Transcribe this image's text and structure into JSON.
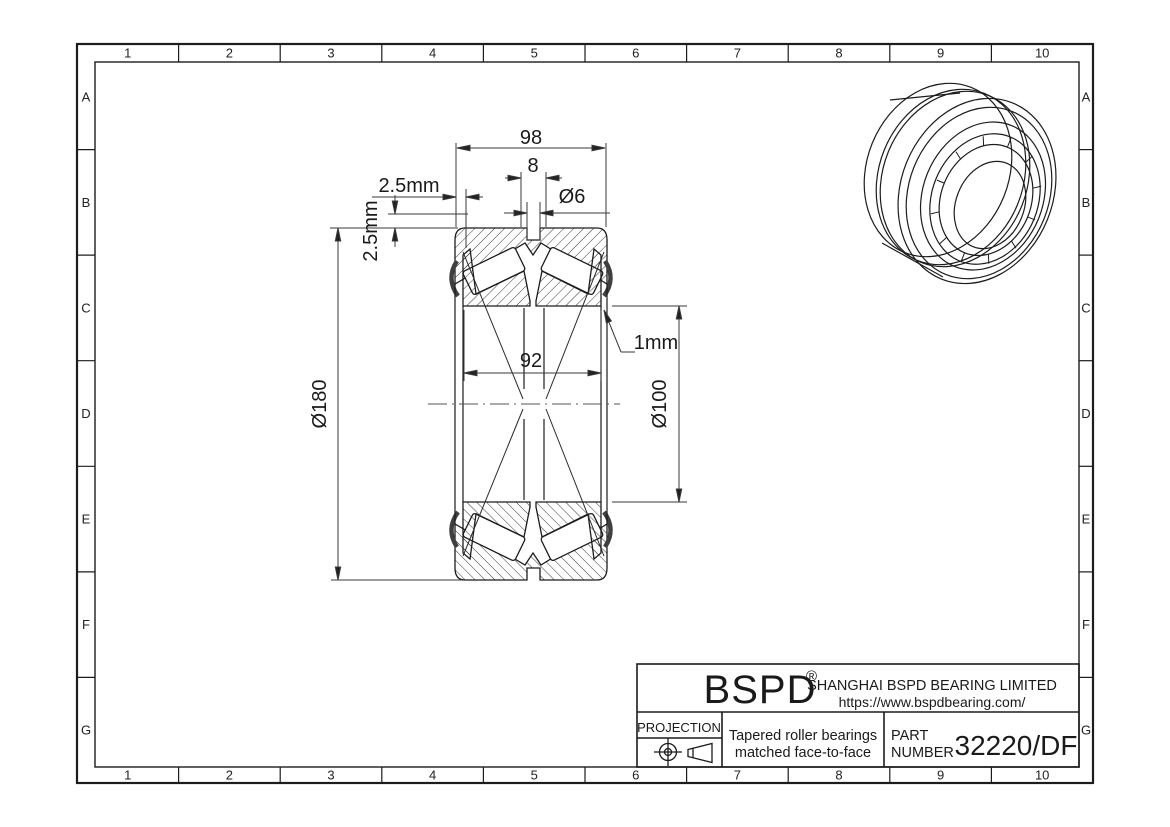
{
  "sheet": {
    "columns": [
      "1",
      "2",
      "3",
      "4",
      "5",
      "6",
      "7",
      "8",
      "9",
      "10"
    ],
    "rows": [
      "A",
      "B",
      "C",
      "D",
      "E",
      "F",
      "G"
    ]
  },
  "title_block": {
    "brand": "BSPD",
    "registered_mark": "®",
    "company": "SHANGHAI BSPD BEARING LIMITED",
    "website": "https://www.bspdbearing.com/",
    "projection_label": "PROJECTION",
    "description_line1": "Tapered roller bearings",
    "description_line2": "matched face-to-face",
    "part_label_line1": "PART",
    "part_label_line2": "NUMBER",
    "part_number": "32220/DF"
  },
  "dimensions": {
    "overall_width": "98",
    "groove_width": "8",
    "oil_hole_diameter": "Ø6",
    "offset_horizontal": "2.5mm",
    "offset_vertical": "2.5mm",
    "outer_diameter": "Ø180",
    "inner_rings_width": "92",
    "face_recess": "1mm",
    "bore_diameter": "Ø100"
  },
  "colors": {
    "line": "#1c1c1c",
    "dim_line": "#3a3a3a",
    "seal": "#3f3f3f",
    "background": "#ffffff"
  }
}
